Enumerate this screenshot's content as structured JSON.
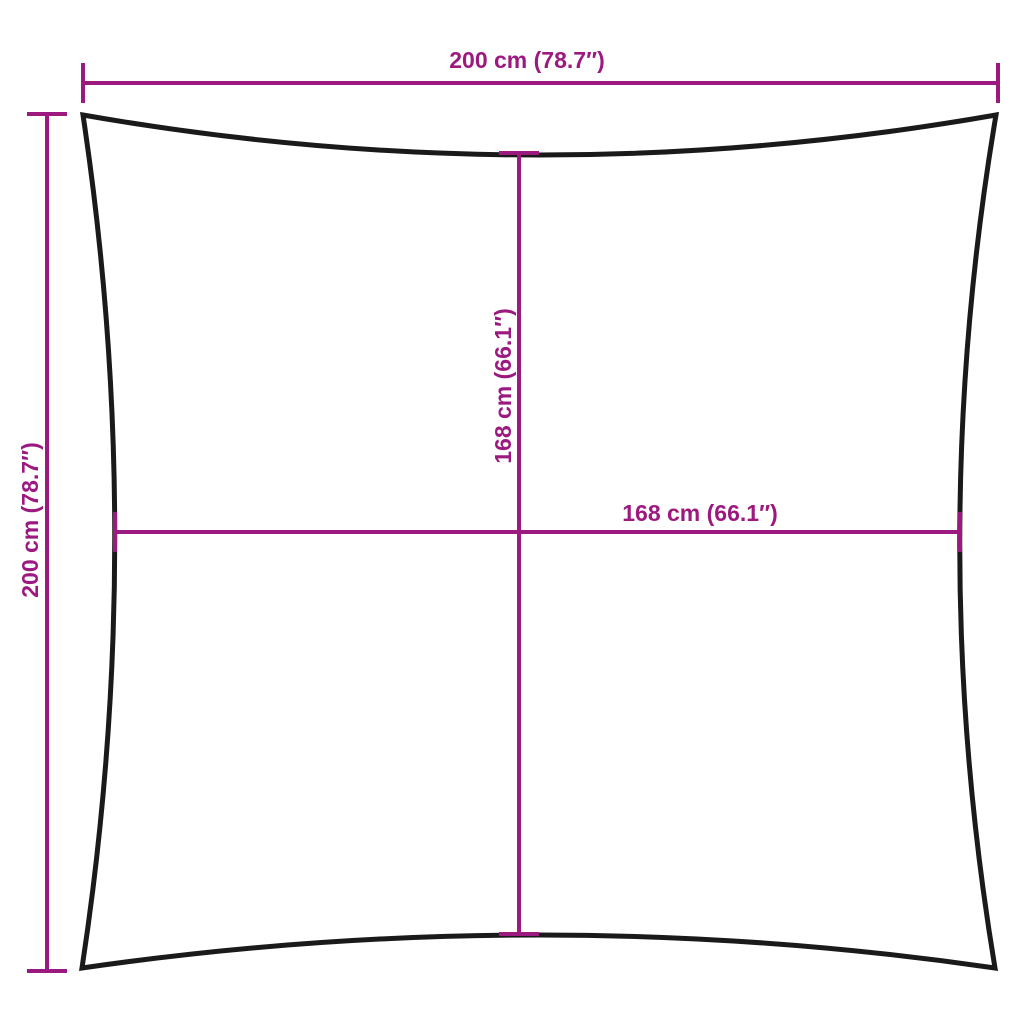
{
  "diagram": {
    "kind": "product-dimension-diagram",
    "shape": "square shade sail with concave edges",
    "labels": {
      "top_width": "200 cm (78.7″)",
      "left_height": "200 cm (78.7″)",
      "inner_height": "168 cm (66.1″)",
      "inner_width": "168 cm (66.1″)"
    },
    "measurements": {
      "outer_width_cm": 200,
      "outer_width_in": 78.7,
      "outer_height_cm": 200,
      "outer_height_in": 78.7,
      "inner_width_cm": 168,
      "inner_width_in": 66.1,
      "inner_height_cm": 168,
      "inner_height_in": 66.1
    },
    "colors": {
      "dimension": "#9C1A80",
      "outline": "#1a1a1a",
      "background": "#ffffff"
    }
  }
}
